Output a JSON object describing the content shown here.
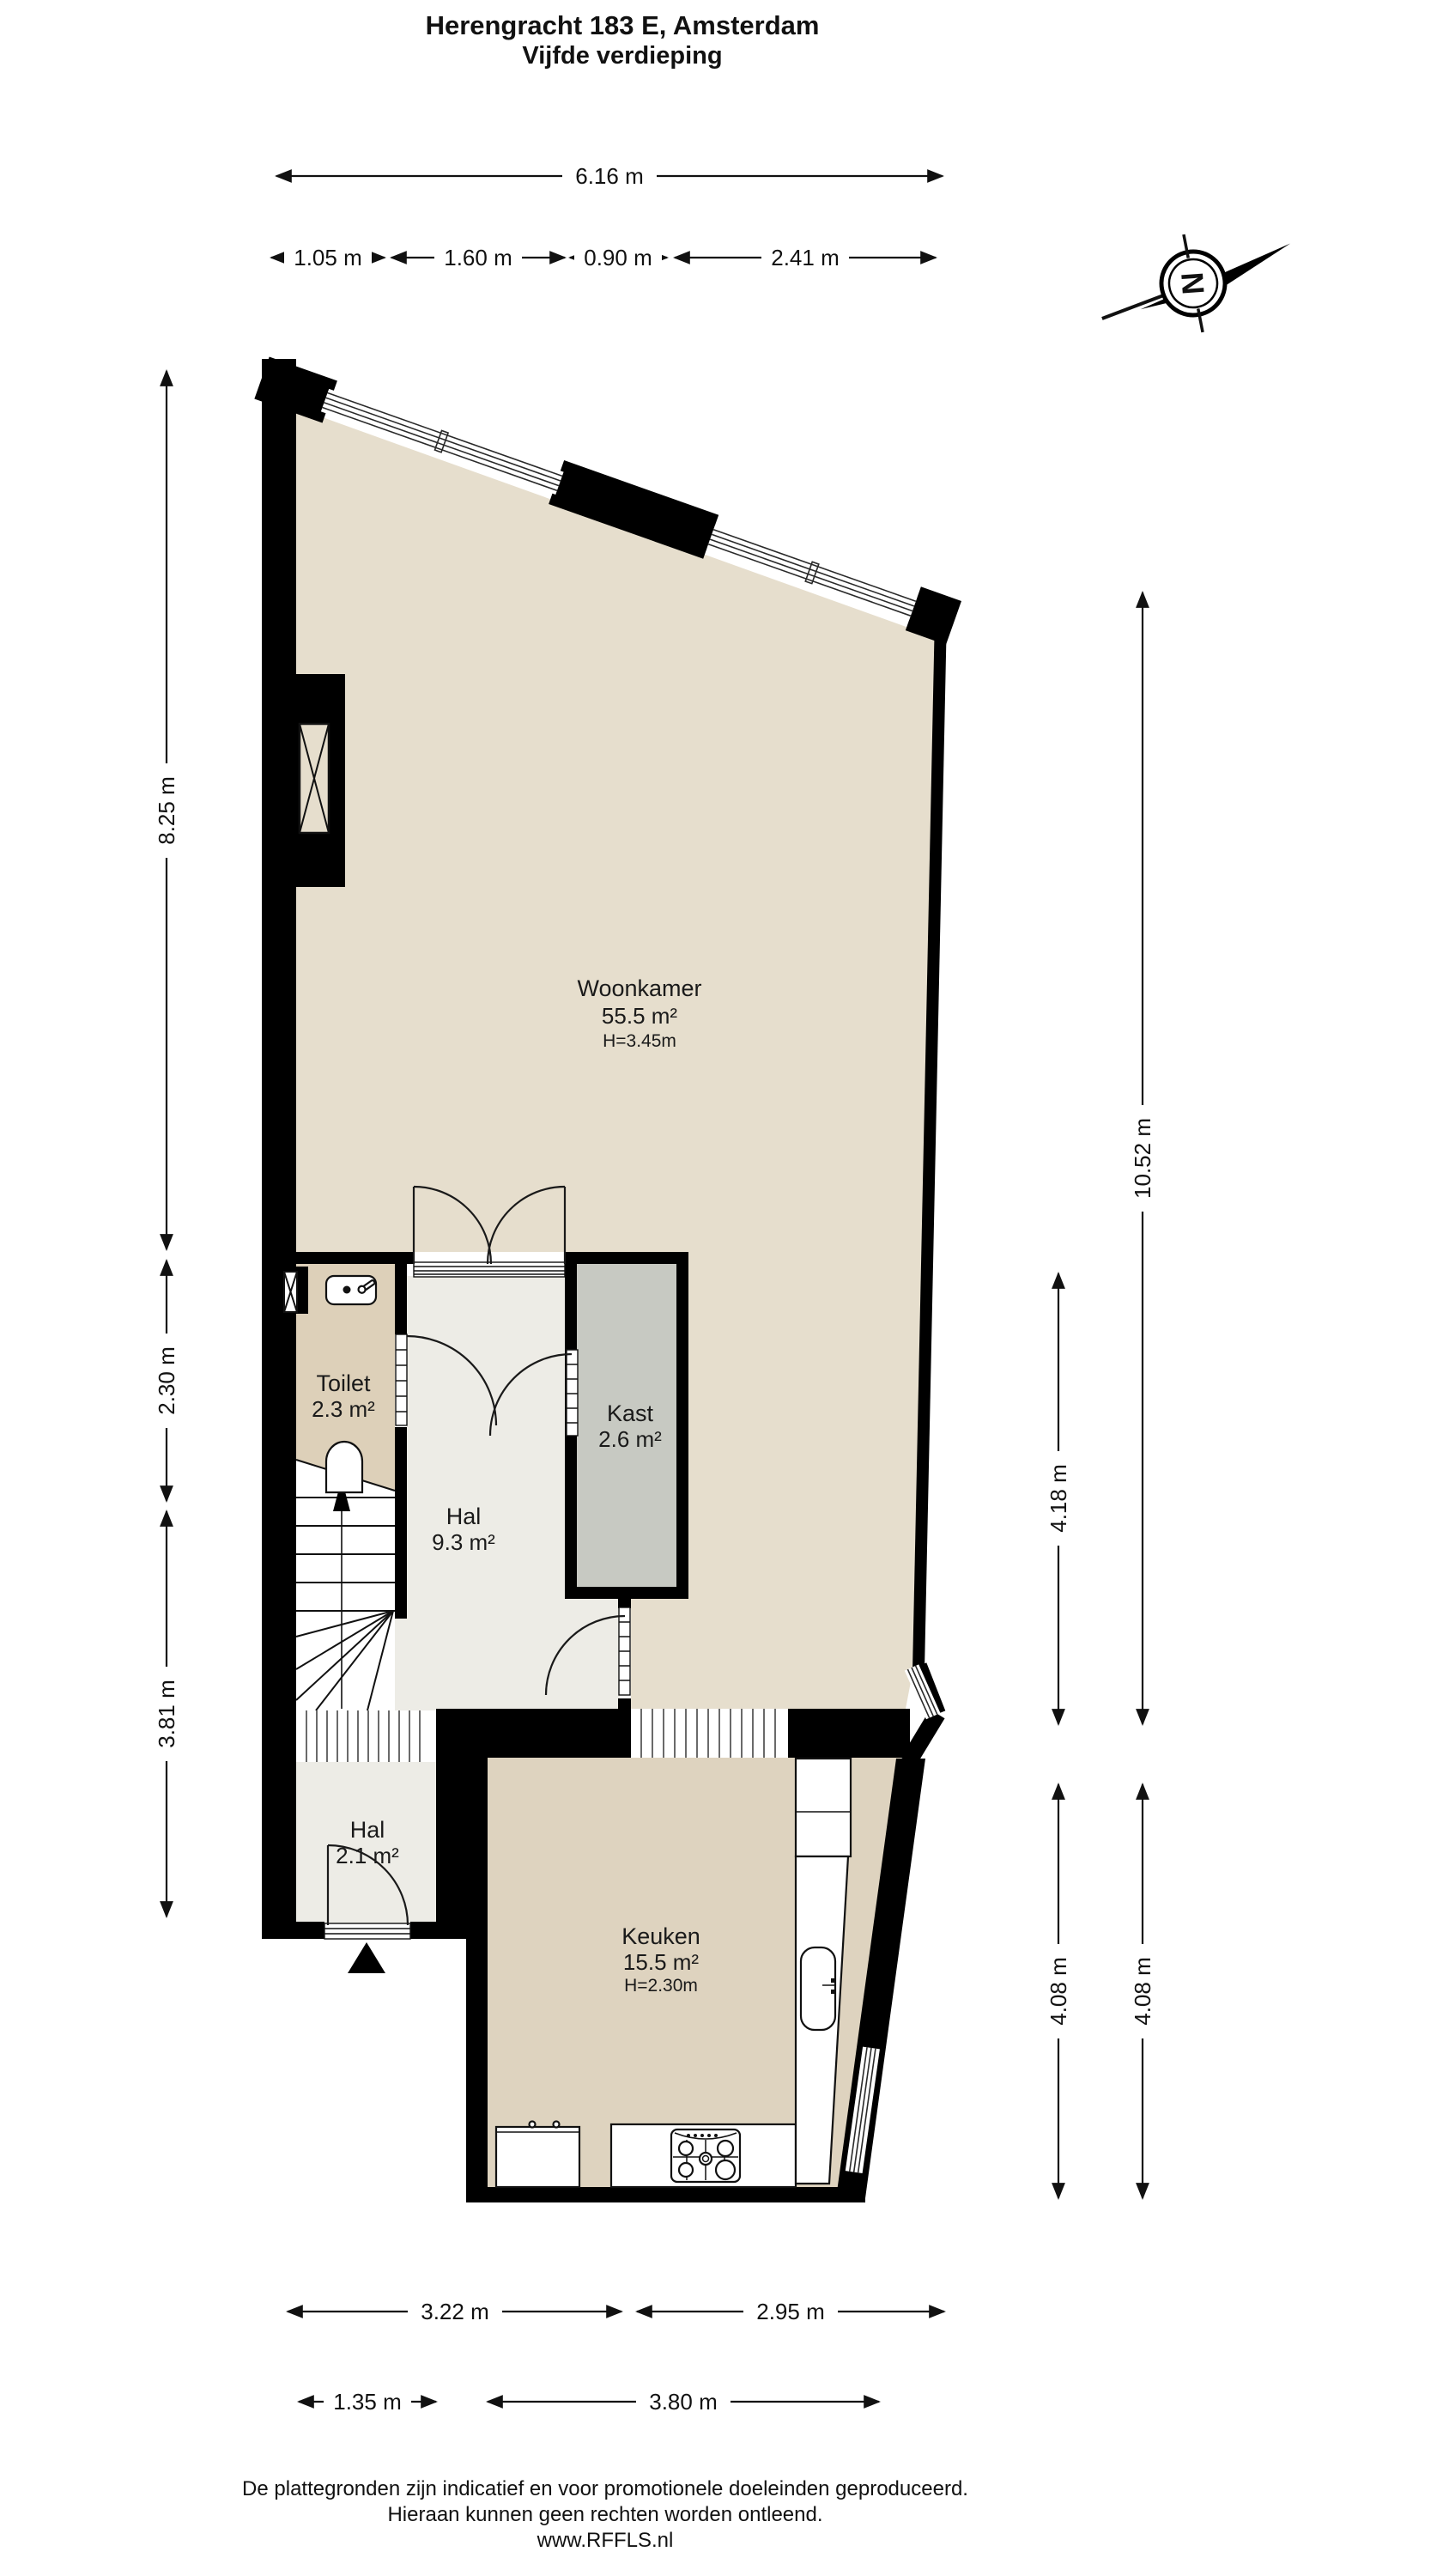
{
  "title": {
    "line1": "Herengracht 183 E, Amsterdam",
    "line2": "Vijfde verdieping"
  },
  "compass": {
    "north_label": "N"
  },
  "rooms": {
    "woonkamer": {
      "name": "Woonkamer",
      "area": "55.5 m²",
      "height": "H=3.45m"
    },
    "toilet": {
      "name": "Toilet",
      "area": "2.3 m²"
    },
    "kast": {
      "name": "Kast",
      "area": "2.6 m²"
    },
    "hal": {
      "name": "Hal",
      "area": "9.3 m²"
    },
    "hal_entree": {
      "name": "Hal",
      "area": "2.1 m²"
    },
    "keuken": {
      "name": "Keuken",
      "area": "15.5 m²",
      "height": "H=2.30m"
    }
  },
  "dimensions": {
    "top": {
      "overall": "6.16 m",
      "segments": [
        "1.05 m",
        "1.60 m",
        "0.90 m",
        "2.41 m"
      ]
    },
    "left": [
      "8.25 m",
      "2.30 m",
      "3.81 m"
    ],
    "right_outer": [
      "10.52 m",
      "4.08 m"
    ],
    "right_inner": [
      "4.18 m",
      "4.08 m"
    ],
    "bottom_row1": [
      "3.22 m",
      "2.95 m"
    ],
    "bottom_row2": [
      "1.35 m",
      "3.80 m"
    ]
  },
  "footer": {
    "line1": "De plattegronden zijn indicatief en voor promotionele doeleinden geproduceerd.",
    "line2": "Hieraan kunnen geen rechten worden ontleend.",
    "line3": "www.RFFLS.nl"
  },
  "colors": {
    "wall": "#000000",
    "floor_woonkamer": "#e6decd",
    "floor_toilet": "#ddd0b9",
    "floor_hal": "#edece6",
    "floor_kast": "#c7c9c2",
    "floor_keuken": "#ded3bf",
    "line": "#111111"
  }
}
